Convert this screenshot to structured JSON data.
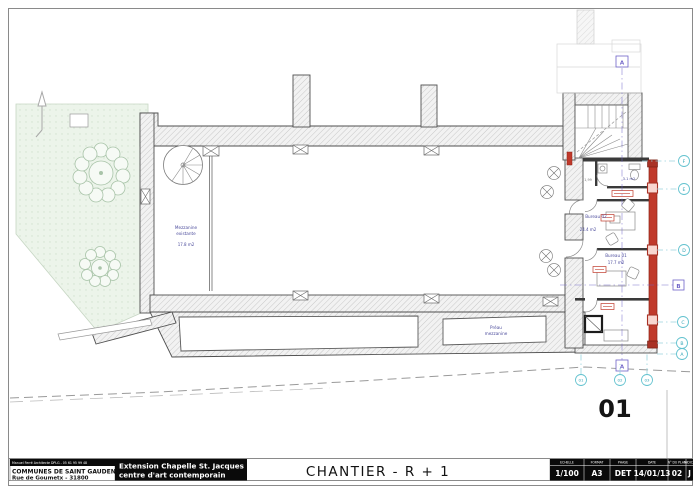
{
  "sheet": {
    "big_plan_number": "01"
  },
  "title_block": {
    "architect_line": "Manuel Ferré Architecte DPLG - 05 61 95 99 48",
    "client_name": "COMMUNES DE SAINT GAUDENS",
    "client_address": "Rue de Goumetx - 31800",
    "project_name_line1": "Extension Chapelle St. Jacques",
    "project_name_line2": "centre d'art contemporain",
    "drawing_title": "CHANTIER  - R + 1",
    "table": {
      "headers": [
        "ECHELLE",
        "FORMAT",
        "PHASE",
        "DATE",
        "N° DU PLAN",
        "INDICE"
      ],
      "values": [
        "1/100",
        "A3",
        "DET",
        "14/01/13",
        "02",
        "J"
      ]
    }
  },
  "rooms": {
    "mezzanine": {
      "name_line1": "Mezzanine",
      "name_line2": "existante",
      "area": "17.8 m2"
    },
    "bureau02": {
      "name": "Bureau 02",
      "area": "24.4 m2"
    },
    "bureau01": {
      "name": "Bureau 01",
      "area": "17.7 m2"
    },
    "sanitaires": {
      "area": "3.1 m2"
    },
    "preau": {
      "name_line1": "Préau",
      "name_line2": "mezzanine"
    }
  },
  "dimensions": {
    "door_width": "1,99"
  },
  "markers": {
    "grid_letters": [
      "F",
      "E",
      "D",
      "C",
      "B",
      "A"
    ],
    "grid_numbers": [
      "01",
      "02",
      "03"
    ],
    "section_a": "A",
    "section_b": "B"
  },
  "colors": {
    "new_work_red": "#c0392b",
    "marker_cyan": "#62c2cf",
    "label_blue": "#4c4c9c",
    "section_purple": "#6f63c8"
  }
}
